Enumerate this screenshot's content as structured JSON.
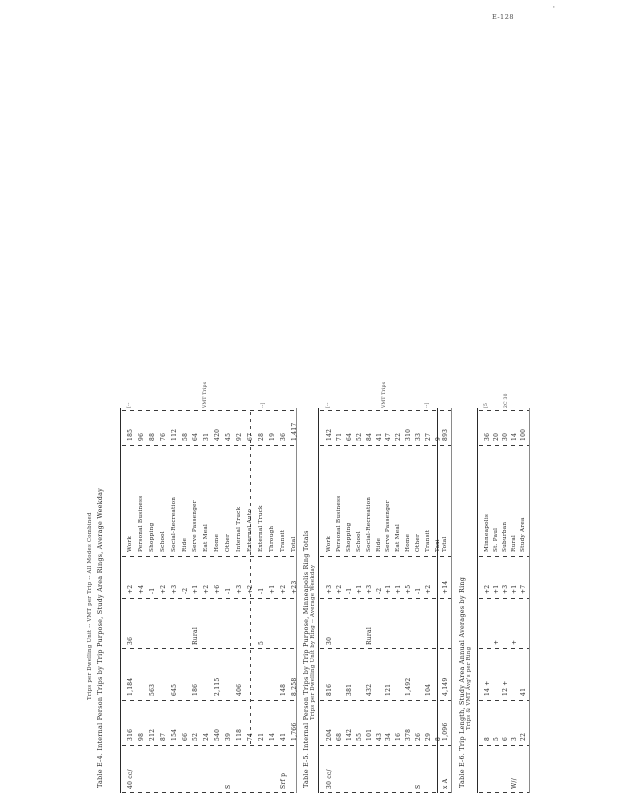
{
  "page": {
    "corner_label": "E-128",
    "corner_mark": "'"
  },
  "tables": [
    {
      "id": "table-1",
      "title": "Table E-4. Internal Person Trips by Trip Purpose, Study Area Rings, Average Weekday",
      "subtitle": "Trips per Dwelling Unit -- VMT per Trip -- All Modes Combined",
      "header_marks": [
        "[--",
        "VMT  Trips",
        "--]"
      ],
      "rows": [
        {
          "label": "Work",
          "a": "185",
          "b": "+2",
          "c": "36",
          "d": "1,184",
          "e": "316",
          "f": "40 cc/"
        },
        {
          "label": "Personal Business",
          "a": "96",
          "b": "+4",
          "c": "",
          "d": "",
          "e": "98",
          "f": ""
        },
        {
          "label": "Shopping",
          "a": "88",
          "b": "-1",
          "c": "",
          "d": "563",
          "e": "212",
          "f": ""
        },
        {
          "label": "School",
          "a": "76",
          "b": "+2",
          "c": "",
          "d": "",
          "e": "87",
          "f": ""
        },
        {
          "label": "Social-Recreation",
          "a": "112",
          "b": "+3",
          "c": "",
          "d": "645",
          "e": "154",
          "f": ""
        },
        {
          "label": "Ride",
          "a": "58",
          "b": "-2",
          "c": "",
          "d": "",
          "e": "66",
          "f": ""
        },
        {
          "label": "Serve Passenger",
          "a": "64",
          "b": "+1",
          "c": "Rural",
          "d": "186",
          "e": "52",
          "f": ""
        },
        {
          "label": "Eat Meal",
          "a": "31",
          "b": "+2",
          "c": "",
          "d": "",
          "e": "24",
          "f": ""
        },
        {
          "label": "Home",
          "a": "420",
          "b": "+6",
          "c": "",
          "d": "2,115",
          "e": "540",
          "f": ""
        },
        {
          "label": "Other",
          "a": "45",
          "b": "-1",
          "c": "",
          "d": "",
          "e": "39",
          "f": "S"
        },
        {
          "label": "Internal Truck",
          "a": "92",
          "b": "+3",
          "c": "",
          "d": "406",
          "e": "118",
          "f": ""
        },
        {
          "label": "External Auto",
          "a": "67",
          "b": "+2",
          "c": "",
          "d": "",
          "e": "74",
          "f": ""
        },
        {
          "label": "External Truck",
          "a": "28",
          "b": "-1",
          "c": "5",
          "d": "",
          "e": "21",
          "f": ""
        },
        {
          "label": "Through",
          "a": "19",
          "b": "+1",
          "c": "",
          "d": "",
          "e": "14",
          "f": ""
        },
        {
          "label": "Transit",
          "a": "36",
          "b": "+2",
          "c": "",
          "d": "148",
          "e": "41",
          "f": "Srf p"
        },
        {
          "label": "Total",
          "a": "1,417",
          "b": "+23",
          "c": "",
          "d": "8,258",
          "e": "1,766",
          "f": ""
        }
      ],
      "total_row": null
    },
    {
      "id": "table-2",
      "title": "Table E-5. Internal Person Trips by Trip Purpose, Minneapolis Ring Totals",
      "subtitle": "Trips per Dwelling Unit by Ring -- Average Weekday",
      "header_marks": [
        "[--",
        "VMT  Trips",
        "--]"
      ],
      "rows": [
        {
          "label": "Work",
          "a": "142",
          "b": "+3",
          "c": "30",
          "d": "816",
          "e": "204",
          "f": "30 cc/"
        },
        {
          "label": "Personal Business",
          "a": "71",
          "b": "+2",
          "c": "",
          "d": "",
          "e": "68",
          "f": ""
        },
        {
          "label": "Shopping",
          "a": "64",
          "b": "-1",
          "c": "",
          "d": "381",
          "e": "142",
          "f": ""
        },
        {
          "label": "School",
          "a": "52",
          "b": "+1",
          "c": "",
          "d": "",
          "e": "55",
          "f": ""
        },
        {
          "label": "Social-Recreation",
          "a": "84",
          "b": "+3",
          "c": "Rural",
          "d": "432",
          "e": "101",
          "f": ""
        },
        {
          "label": "Ride",
          "a": "41",
          "b": "-2",
          "c": "",
          "d": "",
          "e": "43",
          "f": ""
        },
        {
          "label": "Serve Passenger",
          "a": "47",
          "b": "+1",
          "c": "",
          "d": "121",
          "e": "34",
          "f": ""
        },
        {
          "label": "Eat Meal",
          "a": "22",
          "b": "+1",
          "c": "",
          "d": "",
          "e": "16",
          "f": ""
        },
        {
          "label": "Home",
          "a": "310",
          "b": "+5",
          "c": "",
          "d": "1,492",
          "e": "378",
          "f": ""
        },
        {
          "label": "Other",
          "a": "33",
          "b": "-1",
          "c": "",
          "d": "",
          "e": "26",
          "f": "S"
        },
        {
          "label": "Transit",
          "a": "27",
          "b": "+2",
          "c": "",
          "d": "104",
          "e": "29",
          "f": ""
        },
        {
          "label": "Taxi",
          "a": "9",
          "b": "",
          "c": "",
          "d": "",
          "e": "8",
          "f": ""
        }
      ],
      "total_row": {
        "label": "Total",
        "a": "893",
        "b": "+14",
        "c": "",
        "d": "4,149",
        "e": "1,096",
        "f": "x A"
      }
    },
    {
      "id": "table-3",
      "title": "Table E-6. Trip Length, Study Area Annual Averages by Ring",
      "subtitle": "Trips & VMT Avg's per Ring",
      "header_marks": [
        "[5",
        "2C 30",
        ""
      ],
      "rows": [
        {
          "label": "Minneapolis",
          "a": "36",
          "b": "+2",
          "c": "",
          "d": "14 +",
          "e": "8",
          "f": ""
        },
        {
          "label": "St. Paul",
          "a": "20",
          "b": "+1",
          "c": "+",
          "d": "",
          "e": "5",
          "f": ""
        },
        {
          "label": "Suburban",
          "a": "30",
          "b": "+3",
          "c": "",
          "d": "12 +",
          "e": "6",
          "f": ""
        },
        {
          "label": "Rural",
          "a": "14",
          "b": "+1",
          "c": "+",
          "d": "",
          "e": "3",
          "f": "W//"
        },
        {
          "label": "Study Area",
          "a": "100",
          "b": "+7",
          "c": "",
          "d": "41",
          "e": "22",
          "f": ""
        }
      ],
      "total_row": null
    }
  ]
}
